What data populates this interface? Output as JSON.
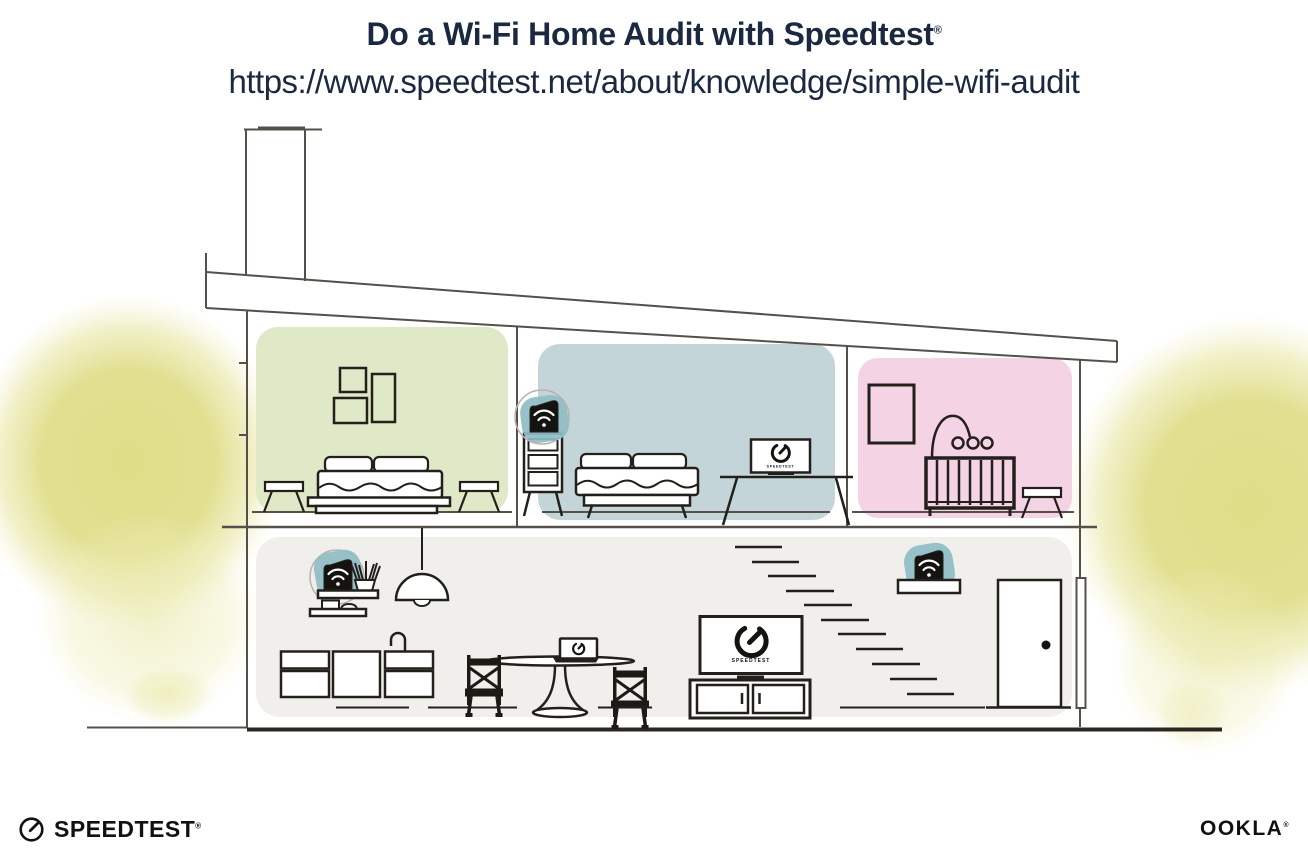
{
  "header": {
    "title": "Do a Wi-Fi Home Audit with Speedtest",
    "registered_mark": "®",
    "url": "https://www.speedtest.net/about/knowledge/simple-wifi-audit"
  },
  "illustration": {
    "description": "Cross-section of a two-story house showing Wi-Fi router and extender placement",
    "rooms": [
      "green bedroom",
      "blue bedroom",
      "pink nursery",
      "open living floor"
    ],
    "devices": [
      {
        "name": "wifi-extender",
        "location": "blue bedroom dresser"
      },
      {
        "name": "wifi-router",
        "location": "living room wall shelf"
      },
      {
        "name": "wifi-extender",
        "location": "stair landing shelf"
      }
    ],
    "screens": {
      "bedroom_laptop_label": "SPEEDTEST",
      "living_room_tv_label": "SPEEDTEST"
    },
    "icons": {
      "wifi": "wifi-icon",
      "gauge": "gauge-icon"
    },
    "colors": {
      "line": "#55504a",
      "furniture_line": "#23201c",
      "room_green": "#dfe8c7",
      "room_blue": "#c4d5d9",
      "room_pink": "#f3d3e4",
      "lower_floor": "#f0efeb",
      "device_highlight": "#8fbdc6",
      "tree_yellow": "#ddda7d",
      "text_navy": "#1b2940"
    }
  },
  "footer": {
    "speedtest_logo": "SPEEDTEST",
    "speedtest_trademark": "®",
    "ookla_logo": "OOKLA",
    "ookla_trademark": "®"
  }
}
